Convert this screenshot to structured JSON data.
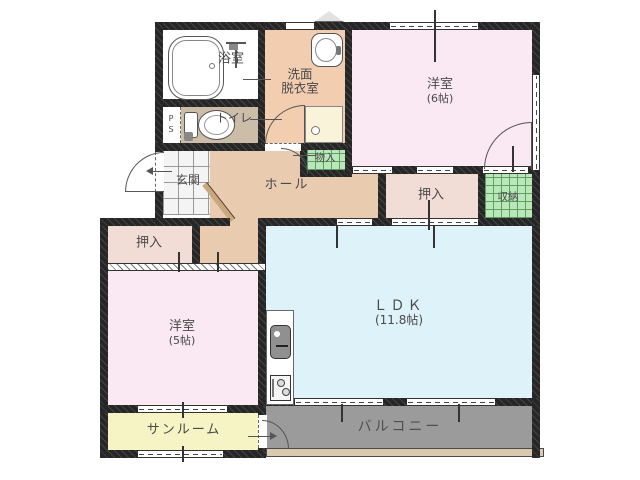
{
  "rooms": {
    "bathroom": {
      "label": "浴室"
    },
    "washroom": {
      "line1": "洗面",
      "line2": "脱衣室"
    },
    "toilet": {
      "label": "トイレ"
    },
    "pipe_space": {
      "label": "PS"
    },
    "entrance": {
      "label": "玄関"
    },
    "hall": {
      "label": "ホール"
    },
    "storage_in": {
      "label": "物入"
    },
    "closet_upper": {
      "label": "押入"
    },
    "storage_right": {
      "label": "収納"
    },
    "bedroom_east": {
      "label": "洋室",
      "size": "(6帖)"
    },
    "closet_west": {
      "label": "押入"
    },
    "bedroom_west": {
      "label": "洋室",
      "size": "(5帖)"
    },
    "ldk": {
      "label": "ＬＤＫ",
      "size": "(11.8帖)"
    },
    "sunroom": {
      "label": "サンルーム"
    },
    "balcony": {
      "label": "バルコニー"
    }
  },
  "colors": {
    "wall": "#262626",
    "bedroom_pink": "#fae8f3",
    "ldk_blue": "#def2f9",
    "hall_tan": "#e9cbb0",
    "washroom_peach": "#f3cdaf",
    "toilet_tan": "#cbbda7",
    "closet_pink": "#f1dcd6",
    "storage_green": "#b9e7ba",
    "sunroom_yellow": "#f6f3c4",
    "balcony_gray": "#9b9b9b",
    "bath_white": "#ffffff",
    "ledge_beige": "#d8c9af"
  }
}
